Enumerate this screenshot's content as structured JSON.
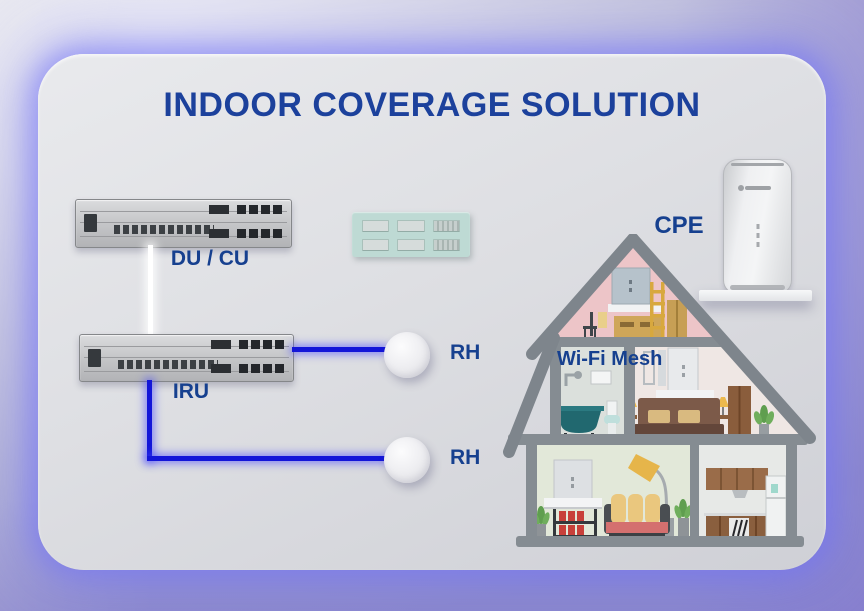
{
  "slide": {
    "title": "INDOOR COVERAGE SOLUTION"
  },
  "nodes": {
    "du_cu": {
      "label": "DU / CU",
      "kind": "baseband-unit"
    },
    "iru": {
      "label": "IRU",
      "kind": "indoor-radio-unit"
    },
    "rh_top": {
      "label": "RH",
      "kind": "radio-head"
    },
    "rh_bottom": {
      "label": "RH",
      "kind": "radio-head"
    },
    "cpe": {
      "label": "CPE",
      "kind": "cpe-router"
    },
    "wifi_mesh": {
      "label": "Wi-Fi Mesh",
      "kind": "mesh-network"
    }
  },
  "links": [
    {
      "from": "du_cu",
      "to": "iru",
      "style": "white-cable"
    },
    {
      "from": "iru",
      "to": "rh_top",
      "style": "blue-cable"
    },
    {
      "from": "iru",
      "to": "rh_bottom",
      "style": "blue-cable"
    }
  ],
  "colors": {
    "title_blue": "#1c419c",
    "label_blue": "#16408f",
    "cable_blue": "#1315d8",
    "cable_white": "#ffffff",
    "panel_teal": "#bedad4",
    "house_gray": "#858c92",
    "glow_violet": "#8d8df0"
  }
}
